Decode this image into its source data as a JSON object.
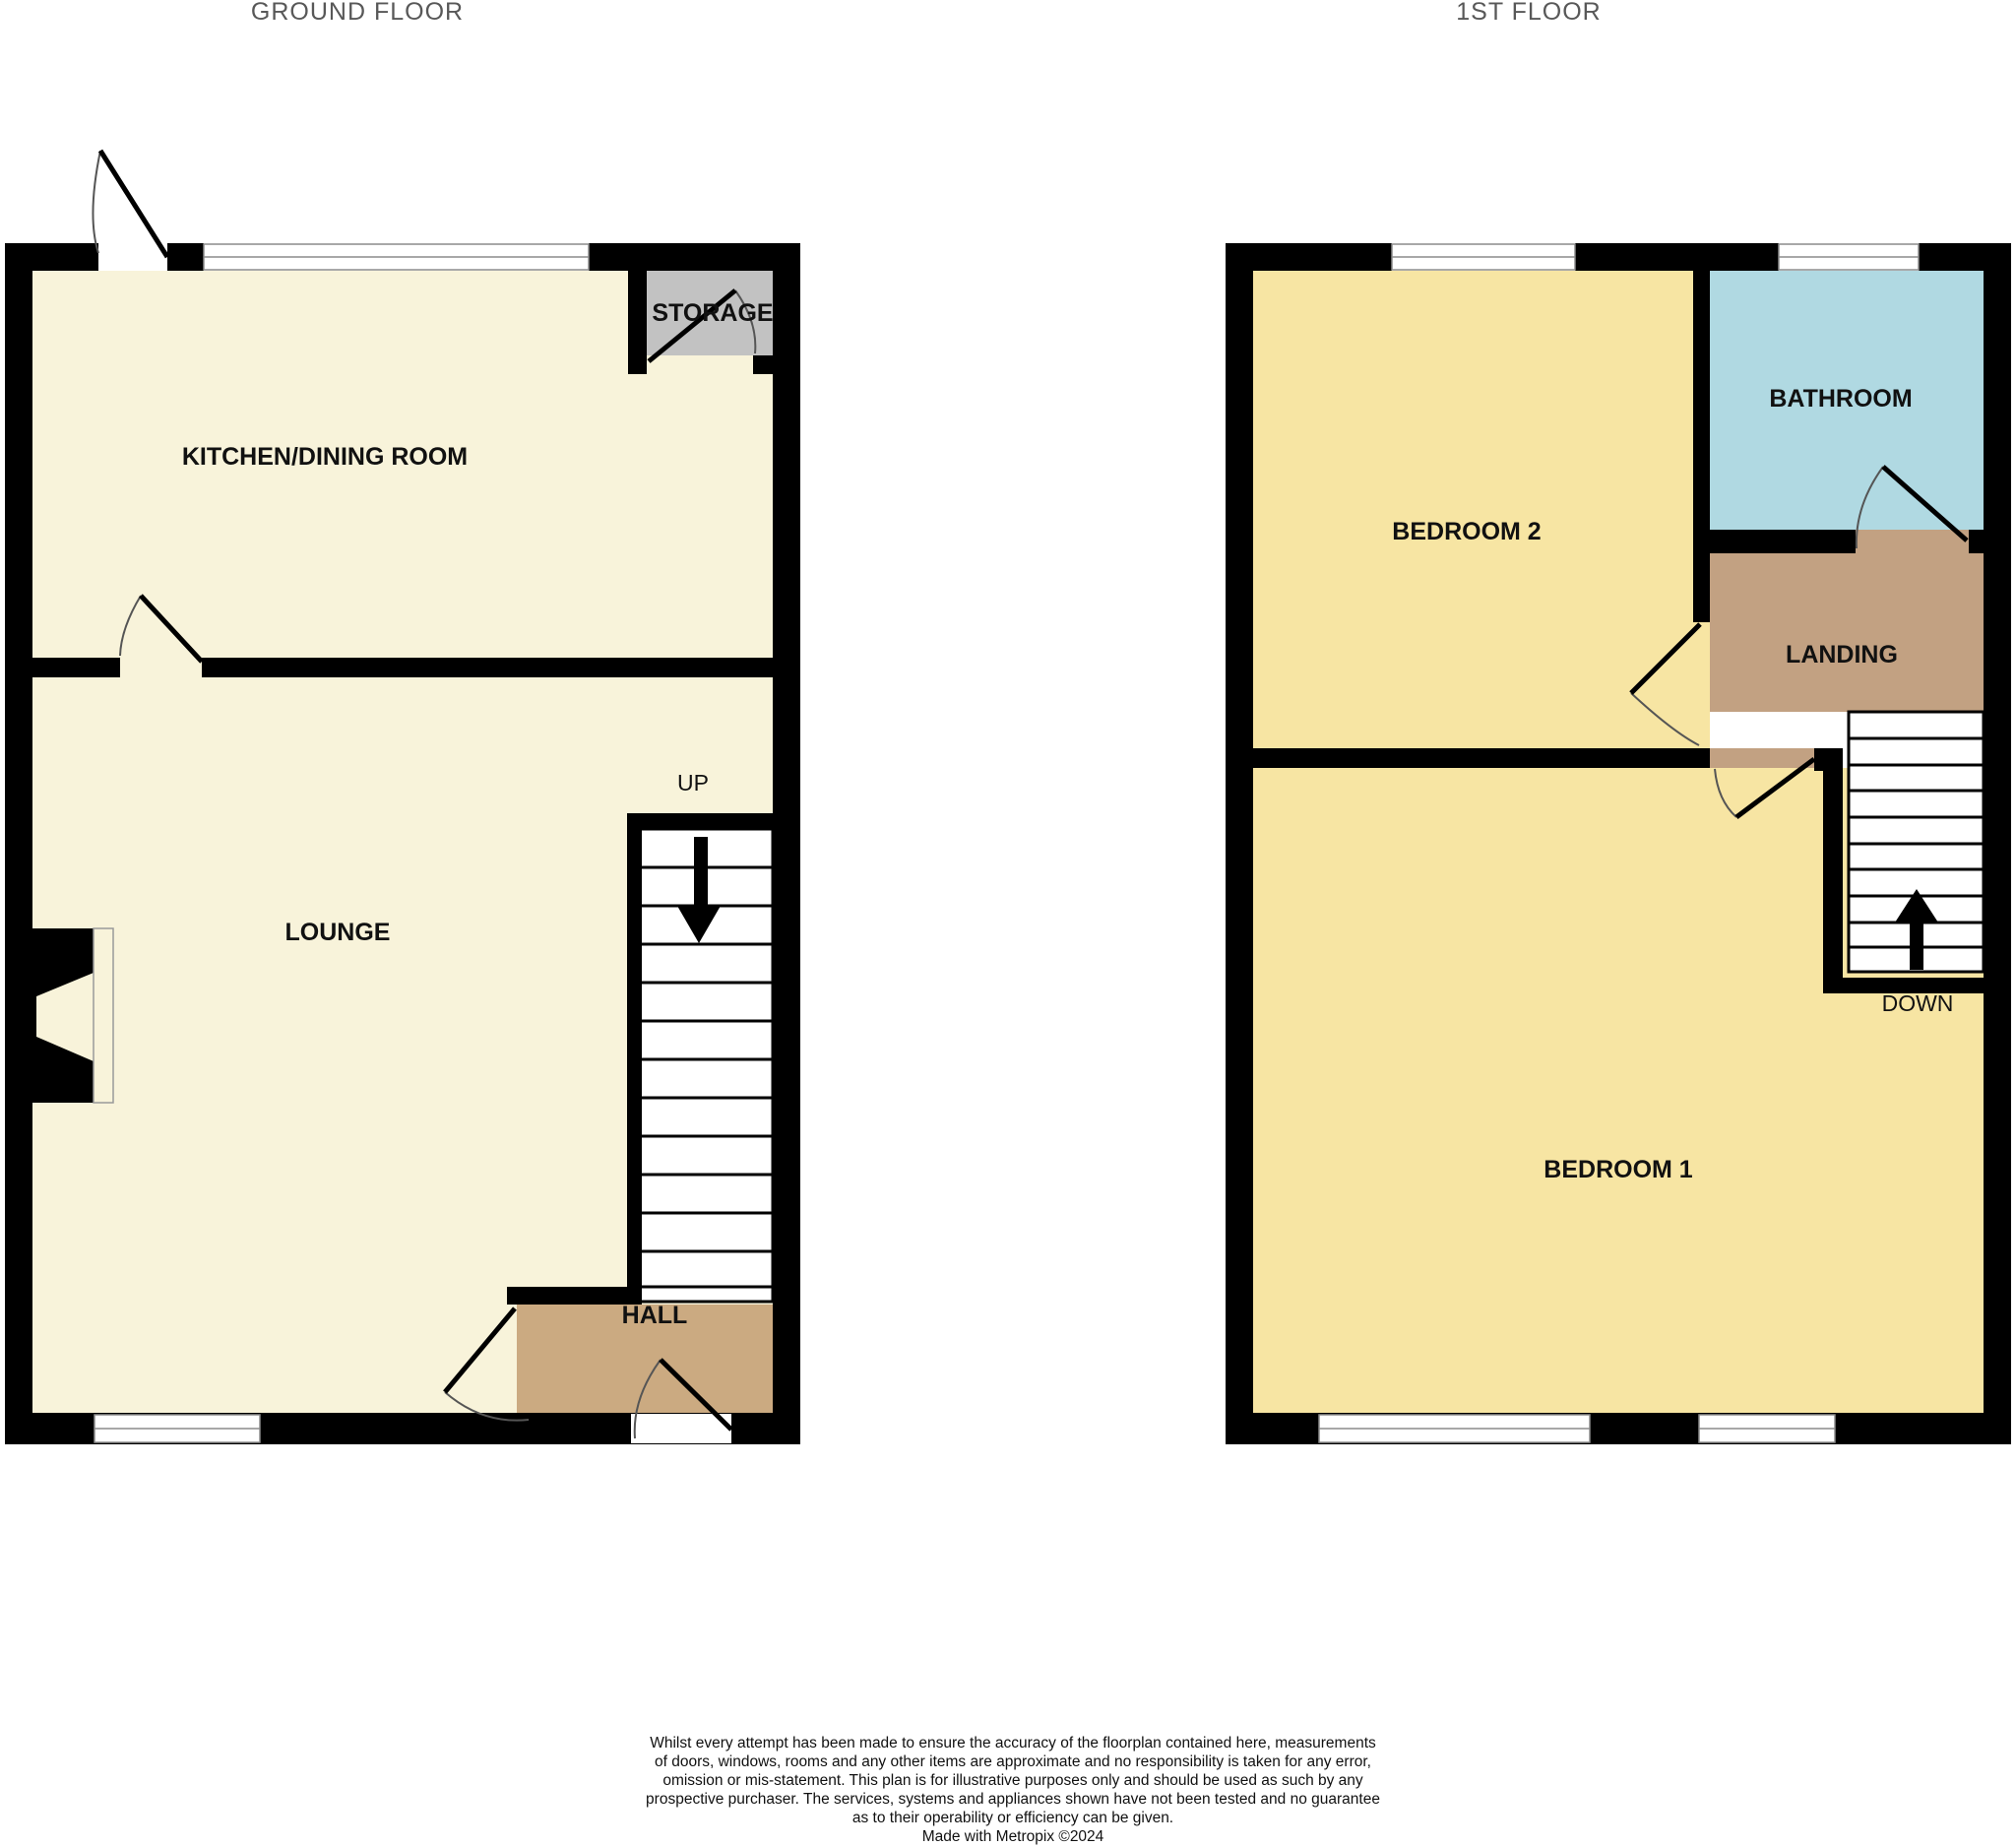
{
  "titles": {
    "ground": "GROUND FLOOR",
    "first": "1ST FLOOR"
  },
  "ground_floor": {
    "rooms": {
      "kitchen": "KITCHEN/DINING ROOM",
      "storage": "STORAGE",
      "lounge": "LOUNGE",
      "hall": "HALL"
    },
    "stairs_label": "UP"
  },
  "first_floor": {
    "rooms": {
      "bedroom2": "BEDROOM 2",
      "bathroom": "BATHROOM",
      "landing": "LANDING",
      "bedroom1": "BEDROOM 1"
    },
    "stairs_label": "DOWN"
  },
  "disclaimer": {
    "lines": [
      "Whilst every attempt has been made to ensure the accuracy of the floorplan contained here, measurements",
      "of doors, windows, rooms and any other items are approximate and no responsibility is taken for any error,",
      "omission or mis-statement. This plan is for illustrative purposes only and should be used as such by any",
      "prospective purchaser. The services, systems and appliances shown have not been tested and no guarantee",
      "as to their operability or efficiency can be given.",
      "Made with Metropix ©2024"
    ]
  },
  "colors": {
    "wall": "#000000",
    "cream": "#f8f3da",
    "bedroom_yellow": "#f7e5a3",
    "bathroom_blue": "#b0d9e2",
    "hall_tan": "#cbaa81",
    "landing_tan": "#c2a182",
    "storage_gray": "#c2c2c2",
    "window_line": "#8c8c8c",
    "door_arc": "#555555",
    "title_text": "#585858",
    "label_text": "#111111"
  }
}
